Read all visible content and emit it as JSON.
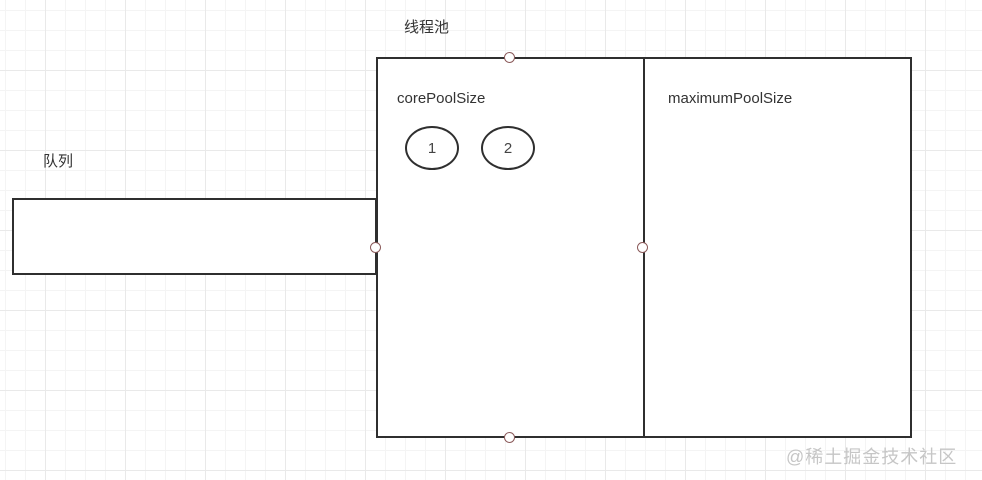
{
  "diagram": {
    "title": "线程池",
    "queue": {
      "label": "队列"
    },
    "pool": {
      "left_section_label": "corePoolSize",
      "right_section_label": "maximumPoolSize",
      "threads": [
        {
          "label": "1"
        },
        {
          "label": "2"
        }
      ]
    },
    "watermark": "@稀土掘金技术社区",
    "colors": {
      "shape_border": "#2f2f2f",
      "handle_border": "#8b5a5a",
      "text": "#333333",
      "watermark_text": "#c6c6c6",
      "grid_minor": "#f4f4f4",
      "grid_major": "#e9e9e9",
      "canvas_background": "#ffffff"
    }
  }
}
